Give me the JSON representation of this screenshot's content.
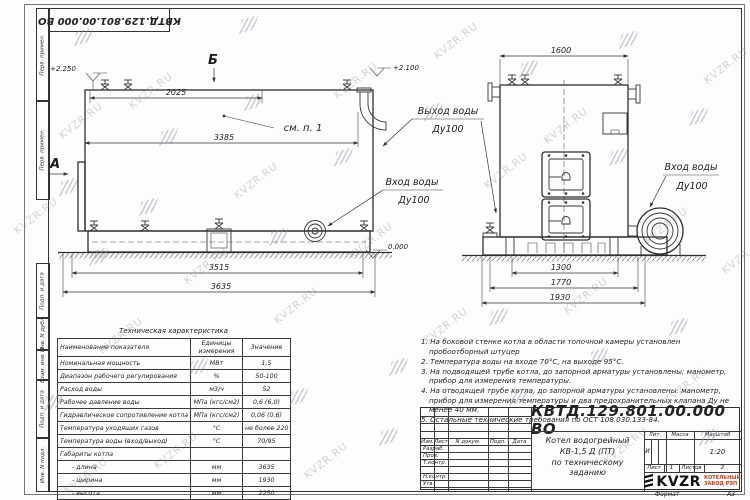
{
  "watermark": {
    "text": "KVZR.RU"
  },
  "stamp": {
    "doc_number": "КВТД.129.801.00.000  ВО"
  },
  "margin": {
    "labels": [
      "Перв. примен.",
      "Перв. примен.",
      "Подп. и дата",
      "Инв. N дубл.",
      "Взам. инв. N",
      "Подп. и дата",
      "Инв. N подл."
    ]
  },
  "views": {
    "view_b": "Б",
    "view_a": "А",
    "see_note": "см. п. 1",
    "elev_top_left": "+2.250",
    "elev_top_right": "+2.100",
    "elev_zero": "0.000",
    "dim_2025": "2025",
    "dim_3385": "3385",
    "dim_3515": "3515",
    "dim_3635": "3635",
    "dim_1600": "1600",
    "dim_1300": "1300",
    "dim_1770": "1770",
    "dim_1930": "1930",
    "inlet_side_line1": "Вход воды",
    "inlet_side_line2": "Ду100",
    "inlet_front_line1": "Вход воды",
    "inlet_front_line2": "Ду100",
    "outlet_line1": "Выход воды",
    "outlet_line2": "Ду100"
  },
  "tech_table": {
    "title": "Техническая характеристика",
    "headers": [
      "Наименование показателя",
      "Единицы измерения",
      "Значение"
    ],
    "rows": [
      [
        "Номинальная мощность",
        "МВт",
        "1,5"
      ],
      [
        "Диапазон рабочего регулирования",
        "%",
        "50-100"
      ],
      [
        "Расход воды",
        "м3/ч",
        "52"
      ],
      [
        "Рабочее давление воды",
        "МПа (кгс/см2)",
        "0,6 (6,0)"
      ],
      [
        "Гидравлическое сопротивление котла",
        "МПа (кгс/см2)",
        "0,06 (0,6)"
      ],
      [
        "Температура уходящих газов",
        "°С",
        "не более 220"
      ],
      [
        "Температура воды (вход/выход)",
        "°С",
        "70/95"
      ],
      [
        "Габариты котла",
        "",
        ""
      ],
      [
        "- длина",
        "мм",
        "3635"
      ],
      [
        "- ширина",
        "мм",
        "1930"
      ],
      [
        "- высота",
        "мм",
        "2250"
      ]
    ]
  },
  "notes": {
    "items": [
      "1.  На боковой стенке котла в области топочной камеры установлен пробоотборный штуцер",
      "2.  Температура воды на входе 70°С, на выходе 95°С.",
      "3.  На подводящей трубе котла, до запорной арматуры установлены: манометр, прибор для измерения температуры.",
      "4.  На отводящей трубе котла, до запорной арматуры установлены: манометр, прибор для измерения температуры и два предохранительных клапана Ду не менее 40 мм.",
      "5.  Остальные технические требования по ОСТ 108.030.133-84."
    ]
  },
  "title_block": {
    "doc_number": "КВТД.129.801.00.000  ВО",
    "rev_headers": [
      "Изм.",
      "Лист",
      "N докум.",
      "Подп.",
      "Дата"
    ],
    "row_labels": [
      "Разраб.",
      "Пров.",
      "Т.контр.",
      "Н.контр.",
      "Утв."
    ],
    "title_line1": "Котел водогрейный",
    "title_line2": "КВ-1,5 Д (ПТ)",
    "title_line3": "по техническому заданию",
    "lit_header": "Лит.",
    "mass_header": "Масса",
    "scale_header": "Масштаб",
    "lit_value": "И",
    "scale_value": "1:20",
    "sheet_label": "Лист",
    "sheet_value": "1",
    "sheets_label": "Листов",
    "sheets_value": "2",
    "logo_text": "KVZR",
    "logo_sub1": "КОТЕЛЬНЫЙ",
    "logo_sub2": "ЗАВОД РЭП",
    "logo_sub_color": "#b5442a",
    "format_label": "Формат",
    "format_value": "А3"
  }
}
